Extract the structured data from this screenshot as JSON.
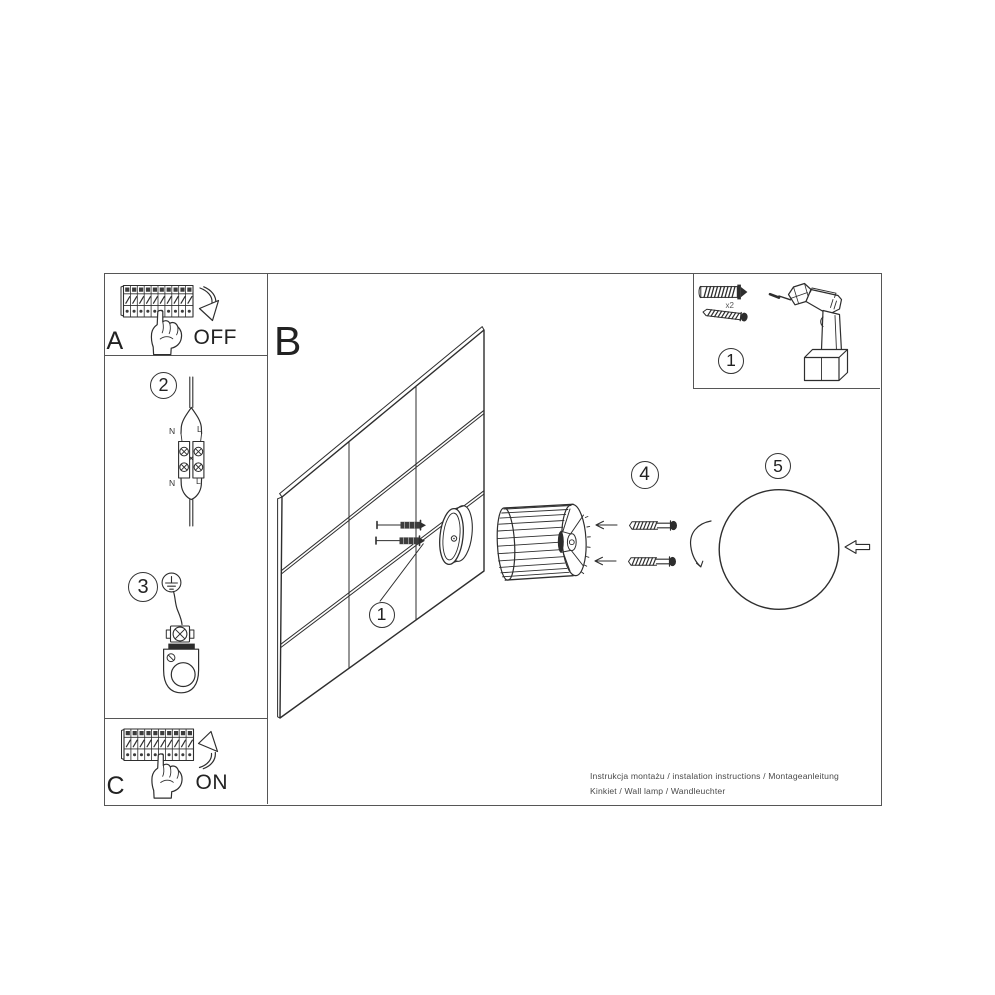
{
  "canvas": {
    "bg": "#ffffff",
    "ink": "#2e2e2e",
    "frame_color": "#565656",
    "text_color": "#222222",
    "muted_text_color": "#4a4a4a"
  },
  "sections": {
    "power_off": {
      "id_letter": "A",
      "switch_label": "OFF"
    },
    "power_on": {
      "id_letter": "C",
      "switch_label": "ON"
    },
    "mounting": {
      "id_letter": "B"
    }
  },
  "step_badges": {
    "tools": "1",
    "wall": "1",
    "wiring": "2",
    "ground": "3",
    "screws": "4",
    "shade": "5"
  },
  "wiring_labels": {
    "top_neutral": "N",
    "top_live": "L",
    "bottom_neutral": "N",
    "bottom_live": "L"
  },
  "tools": {
    "anchor_quantity": "x2"
  },
  "footer": {
    "line1": "Instrukcja montażu / instalation instructions / Montageanleitung",
    "line2": "Kinkiet / Wall lamp / Wandleuchter"
  }
}
